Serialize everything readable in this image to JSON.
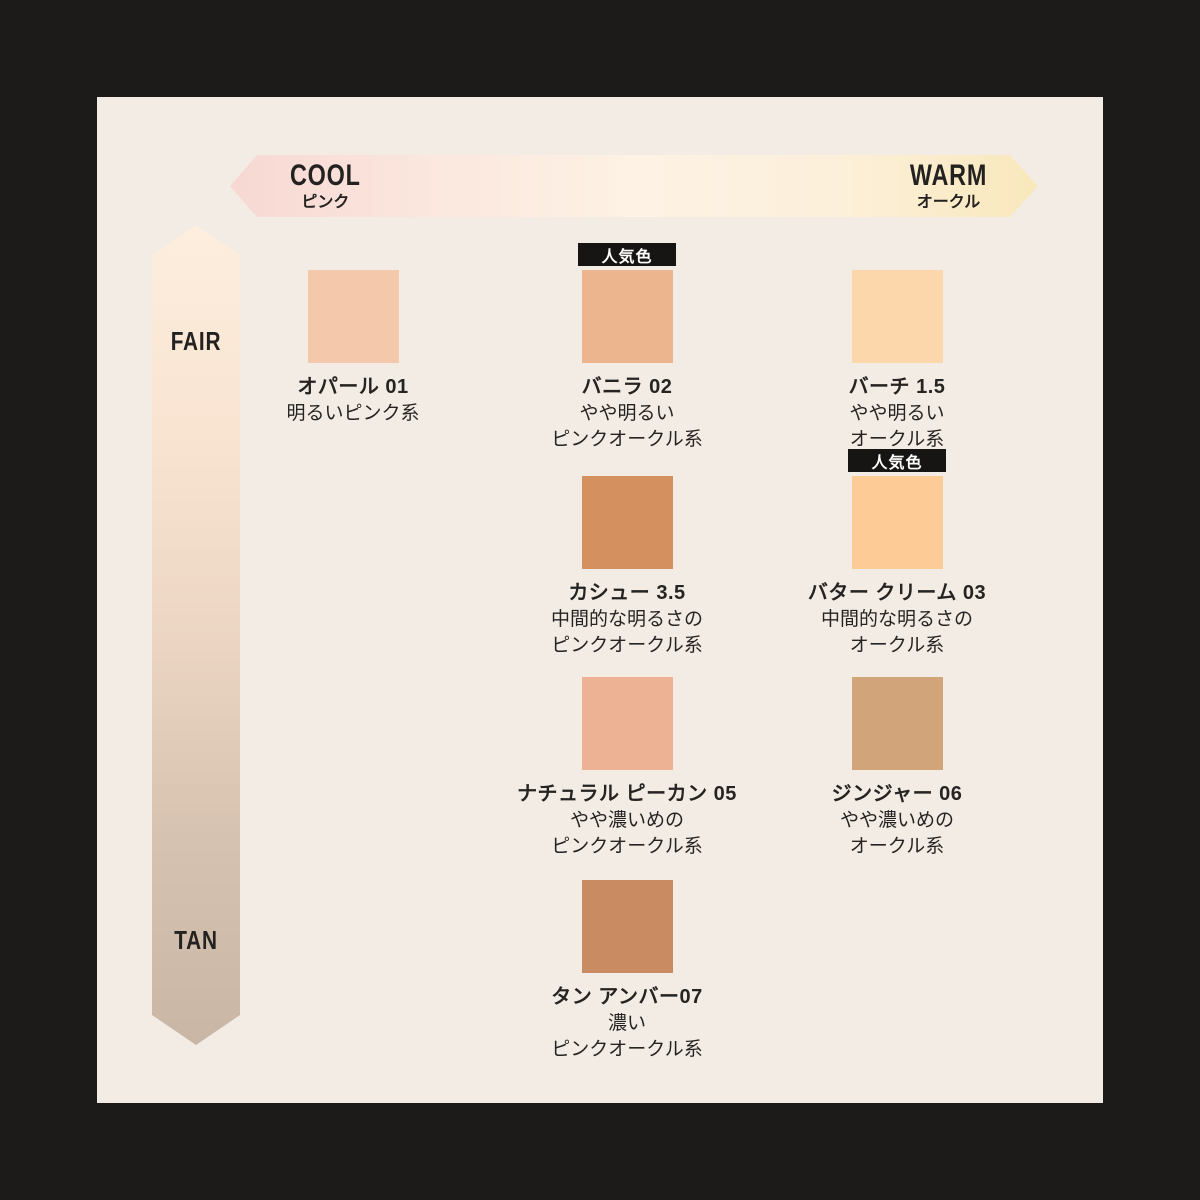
{
  "frame": {
    "outer_background": "#1d1b19",
    "panel_background": "#f3ece5",
    "text_color": "#262422"
  },
  "axes": {
    "horizontal": {
      "left_label": "COOL",
      "left_sublabel": "ピンク",
      "right_label": "WARM",
      "right_sublabel": "オークル",
      "gradient": [
        "#f7d8d2",
        "#fbe7de",
        "#fdf2e4",
        "#fcf0da",
        "#f9e8bc"
      ]
    },
    "vertical": {
      "top_label": "FAIR",
      "bottom_label": "TAN",
      "gradient": [
        "#fdeede",
        "#f9e4d2",
        "#ecd5c3",
        "#d6c2b0",
        "#c9b6a4"
      ]
    }
  },
  "badge_label": "人気色",
  "badge_colors": {
    "background": "#171513",
    "text": "#ffffff"
  },
  "shades": [
    {
      "name": "オパール 01",
      "desc_lines": [
        "明るいピンク系"
      ],
      "color": "#f4c8ab",
      "popular": false,
      "col": 1,
      "row": 1
    },
    {
      "name": "バニラ 02",
      "desc_lines": [
        "やや明るい",
        "ピンクオークル系"
      ],
      "color": "#ecb58d",
      "popular": true,
      "col": 2,
      "row": 1
    },
    {
      "name": "バーチ 1.5",
      "desc_lines": [
        "やや明るい",
        "オークル系"
      ],
      "color": "#fcd7ac",
      "popular": false,
      "col": 3,
      "row": 1
    },
    {
      "name": "カシュー 3.5",
      "desc_lines": [
        "中間的な明るさの",
        "ピンクオークル系"
      ],
      "color": "#d4905f",
      "popular": false,
      "col": 2,
      "row": 2
    },
    {
      "name": "バター クリーム 03",
      "desc_lines": [
        "中間的な明るさの",
        "オークル系"
      ],
      "color": "#fccb96",
      "popular": true,
      "col": 3,
      "row": 2
    },
    {
      "name": "ナチュラル ピーカン 05",
      "desc_lines": [
        "やや濃いめの",
        "ピンクオークル系"
      ],
      "color": "#edb294",
      "popular": false,
      "col": 2,
      "row": 3
    },
    {
      "name": "ジンジャー 06",
      "desc_lines": [
        "やや濃いめの",
        "オークル系"
      ],
      "color": "#d2a47a",
      "popular": false,
      "col": 3,
      "row": 3
    },
    {
      "name": "タン アンバー07",
      "desc_lines": [
        "濃い",
        "ピンクオークル系"
      ],
      "color": "#c98b61",
      "popular": false,
      "col": 2,
      "row": 4
    }
  ]
}
